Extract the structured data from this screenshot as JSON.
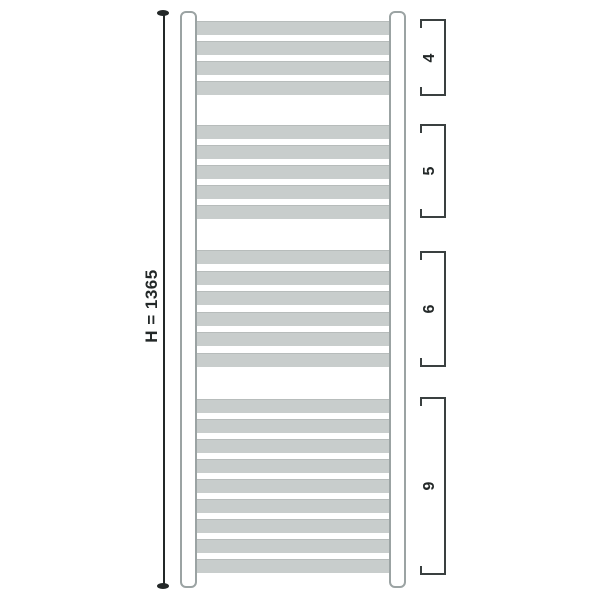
{
  "figure": {
    "description": "Heated towel rail radiator, front elevation technical diagram with overall height dimension and rung-count group annotations"
  },
  "dimension": {
    "label": "H = 1365",
    "value": 1365,
    "axis": "height"
  },
  "rung_groups": [
    {
      "label": "4",
      "count": 4,
      "first_rung_top": 21,
      "last_rung_bottom": 95,
      "bracket_top": 19,
      "bracket_bottom": 96
    },
    {
      "label": "5",
      "count": 5,
      "first_rung_top": 125,
      "last_rung_bottom": 219,
      "bracket_top": 124,
      "bracket_bottom": 218
    },
    {
      "label": "6",
      "count": 6,
      "first_rung_top": 250,
      "last_rung_bottom": 367,
      "bracket_top": 251,
      "bracket_bottom": 367
    },
    {
      "label": "9",
      "count": 9,
      "first_rung_top": 399,
      "last_rung_bottom": 573,
      "bracket_top": 397,
      "bracket_bottom": 575
    }
  ],
  "geometry": {
    "canvas": {
      "width": 600,
      "height": 600
    },
    "rung": {
      "left": 194,
      "width": 199,
      "height": 14
    },
    "bracket": {
      "left": 420,
      "width": 26,
      "label_cx": 430
    }
  },
  "colors": {
    "background": "#ffffff",
    "rung_fill": "#c8cdcc",
    "rung_edge": "#b7bcbb",
    "rail_outline": "#9ba3a3",
    "ink": "#232828",
    "bracket": "#3a4040"
  }
}
